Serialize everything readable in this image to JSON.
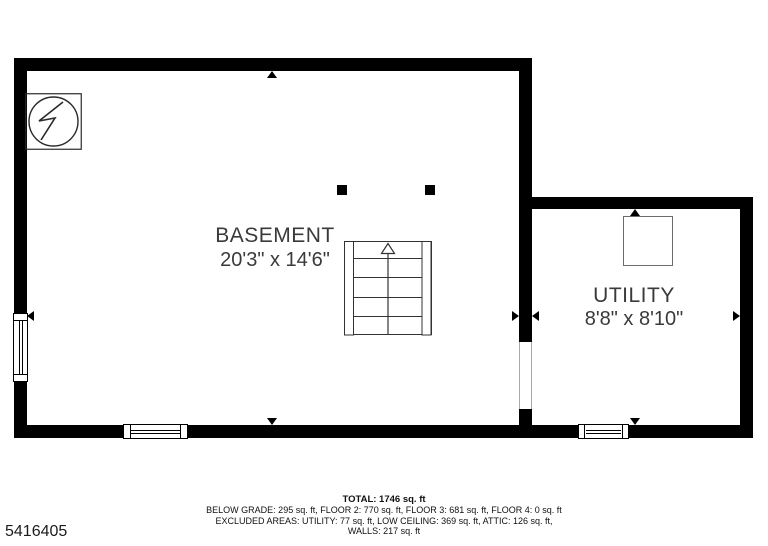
{
  "canvas": {
    "width": 768,
    "height": 546,
    "background": "#ffffff"
  },
  "colors": {
    "wall": "#000000",
    "room_text": "#3a3a3a",
    "symbol_stroke": "#2a2a2a",
    "footer_text": "#111111"
  },
  "rooms": {
    "basement": {
      "name": "BASEMENT",
      "dimensions": "20'3\" x 14'6\""
    },
    "utility": {
      "name": "UTILITY",
      "dimensions": "8'8\" x 8'10\""
    }
  },
  "footer": {
    "total": "TOTAL: 1746 sq. ft",
    "line2": "BELOW GRADE: 295 sq. ft, FLOOR 2: 770 sq. ft, FLOOR 3: 681 sq. ft, FLOOR 4: 0 sq. ft",
    "line3": "EXCLUDED AREAS: UTILITY: 77 sq. ft, LOW CEILING: 369 sq. ft, ATTIC: 126 sq. ft,",
    "line4": "WALLS: 217 sq. ft"
  },
  "plan_id": "5416405",
  "symbols": {
    "electrical_panel": "circle-with-lightning-bolt",
    "stairs": "staircase-with-up-arrow",
    "water_heater": "square-appliance-outline",
    "posts": "two-structural-columns",
    "windows": 3,
    "door_openings": 1
  }
}
